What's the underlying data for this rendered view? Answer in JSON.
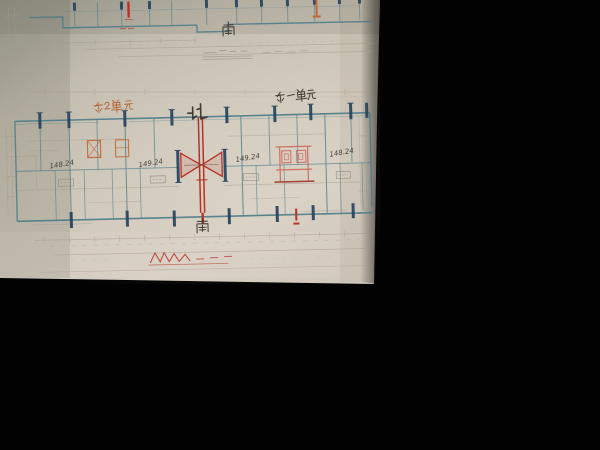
{
  "top_plan": {
    "compass_south": "南"
  },
  "lower_plan": {
    "compass_north": "北",
    "compass_south": "南",
    "unit_label_left": "东2单元",
    "unit_label_right": "东一单元",
    "area_labels": [
      "148.24",
      "149.24",
      "149.24",
      "148.24"
    ]
  },
  "colors": {
    "background": "#000000",
    "paper": "#c9c2b4",
    "wall_teal": "#4c7b88",
    "column_navy": "#27435e",
    "marking_red": "#b63326",
    "marking_orange": "#c4622d",
    "marking_pink": "#cf6a5e",
    "dim_line_gray": "#a59a8a",
    "ink_black": "#37332c"
  }
}
